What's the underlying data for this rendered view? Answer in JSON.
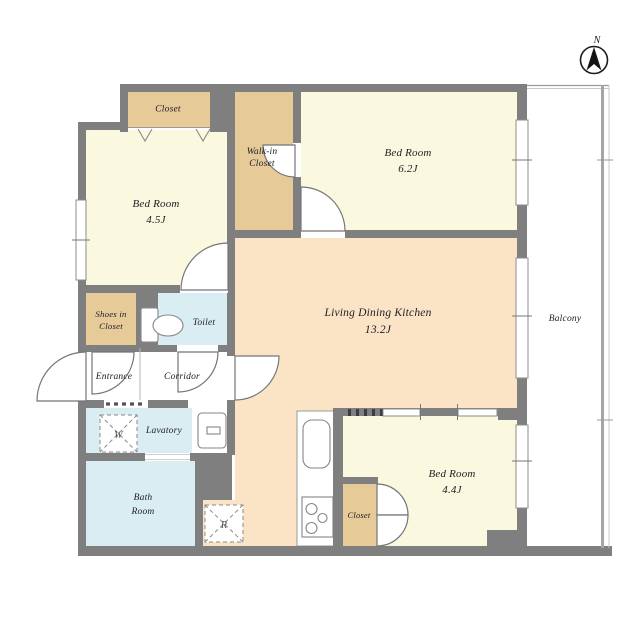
{
  "plan": {
    "rooms": {
      "closet_top": {
        "label": "Closet"
      },
      "walkin_closet": {
        "line1": "Walk-in",
        "line2": "Closet"
      },
      "bedroom_62": {
        "label": "Bed Room",
        "size": "6.2J"
      },
      "bedroom_45": {
        "label": "Bed Room",
        "size": "4.5J"
      },
      "ldk": {
        "label": "Living Dining Kitchen",
        "size": "13.2J"
      },
      "balcony": {
        "label": "Balcony"
      },
      "shoes_closet": {
        "line1": "Shoes in",
        "line2": "Closet"
      },
      "toilet": {
        "label": "Toilet"
      },
      "entrance": {
        "label": "Entrance"
      },
      "corridor": {
        "label": "Corridor"
      },
      "lavatory": {
        "label": "Lavatory"
      },
      "bathroom": {
        "line1": "Bath",
        "line2": "Room"
      },
      "bedroom_44": {
        "label": "Bed Room",
        "size": "4.4J"
      },
      "closet_bottom": {
        "label": "Closet"
      }
    },
    "fixtures": {
      "washer": "W",
      "refrigerator": "R"
    },
    "compass": {
      "north": "N"
    },
    "colors": {
      "wall": "#7f7f7f",
      "bedroom_floor": "#faf8df",
      "ldk_floor": "#fbe4c5",
      "closet_floor": "#e6ca97",
      "wet_area_floor": "#d9edf2",
      "outline": "#9a9a9a",
      "text": "#20202a"
    }
  }
}
